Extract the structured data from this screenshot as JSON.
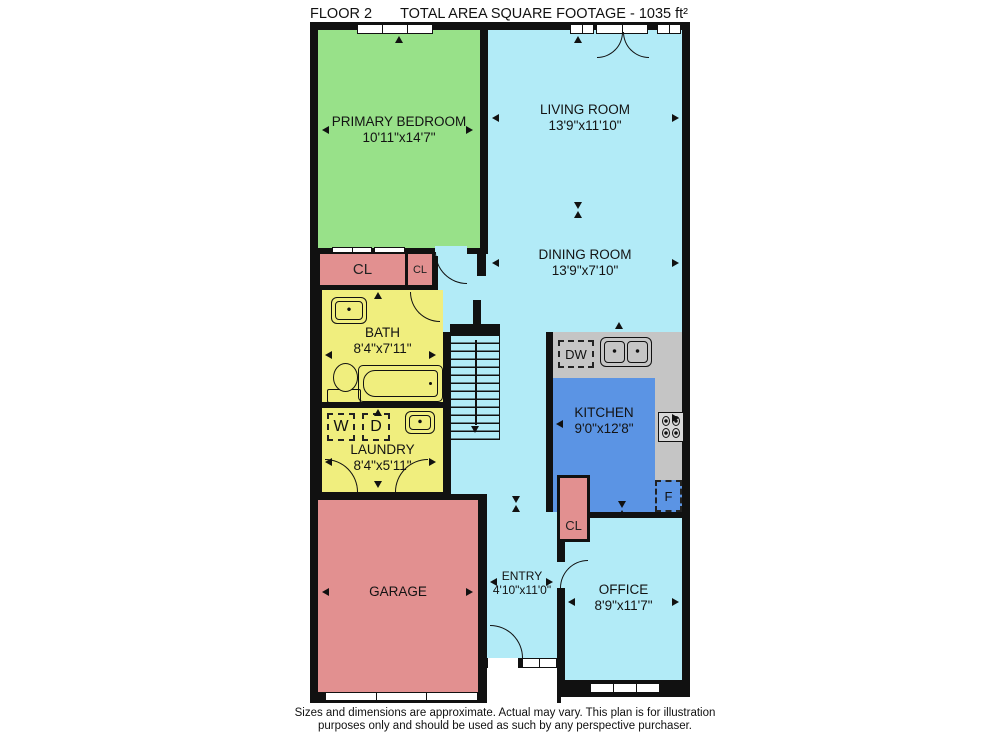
{
  "header": {
    "floor_label": "FLOOR 2",
    "area_label": "TOTAL AREA SQUARE FOOTAGE - 1035 ft²"
  },
  "rooms": {
    "primary_bedroom": {
      "name": "PRIMARY BEDROOM",
      "dims": "10'11\"x14'7\""
    },
    "living_room": {
      "name": "LIVING ROOM",
      "dims": "13'9\"x11'10\""
    },
    "dining_room": {
      "name": "DINING ROOM",
      "dims": "13'9\"x7'10\""
    },
    "bath": {
      "name": "BATH",
      "dims": "8'4\"x7'11\""
    },
    "laundry": {
      "name": "LAUNDRY",
      "dims": "8'4\"x5'11\""
    },
    "kitchen": {
      "name": "KITCHEN",
      "dims": "9'0\"x12'8\""
    },
    "entry": {
      "name": "ENTRY",
      "dims": "4'10\"x11'0\""
    },
    "office": {
      "name": "OFFICE",
      "dims": "8'9\"x11'7\""
    },
    "garage": {
      "name": "GARAGE"
    }
  },
  "labels": {
    "closet": "CL",
    "washer": "W",
    "dryer": "D",
    "dishwasher": "DW",
    "fridge": "F"
  },
  "footer": {
    "disclaimer": "Sizes and dimensions are approximate. Actual may vary. This plan is for illustration purposes only and should be used as such by any perspective purchaser."
  },
  "colors": {
    "bedroom_green": "#98e189",
    "living_blue": "#b2ebf7",
    "bath_yellow": "#f0ee7e",
    "garage_pink": "#e29090",
    "kitchen_blue": "#5b94e4",
    "counter_gray": "#c5c5c5",
    "wall_black": "#111111"
  }
}
